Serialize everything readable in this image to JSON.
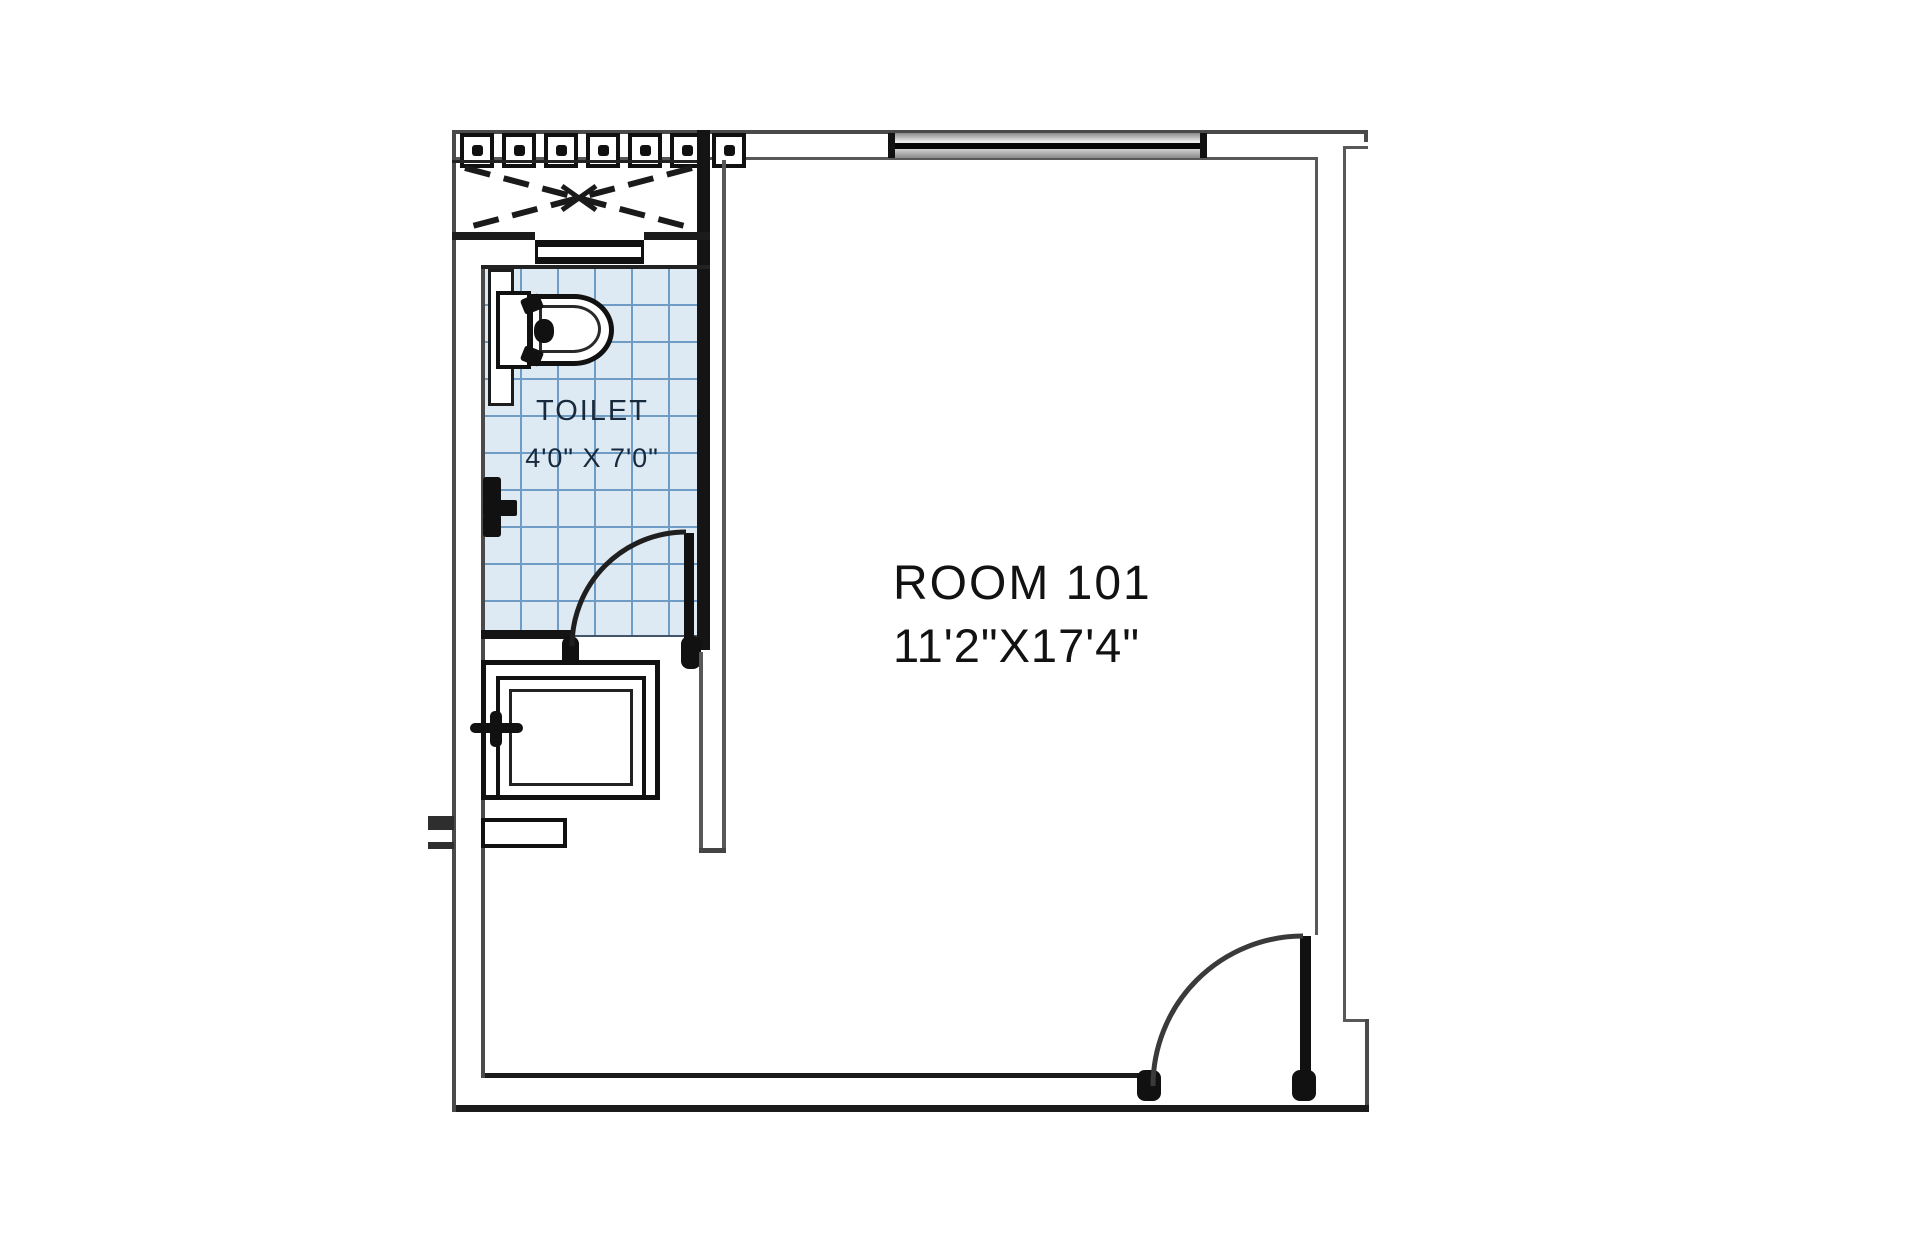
{
  "plan": {
    "toilet": {
      "label": "TOILET",
      "dims": "4'0\" X 7'0\""
    },
    "room": {
      "label": "ROOM 101",
      "dims": "11'2\"X17'4\""
    }
  },
  "colors": {
    "tile_fill": "#dde9f3",
    "tile_grid": "#6f9cc4",
    "wall_dark": "#1b1b1b",
    "wall_gray": "#585858",
    "label_text": "#17293c",
    "room_text": "#121212"
  }
}
